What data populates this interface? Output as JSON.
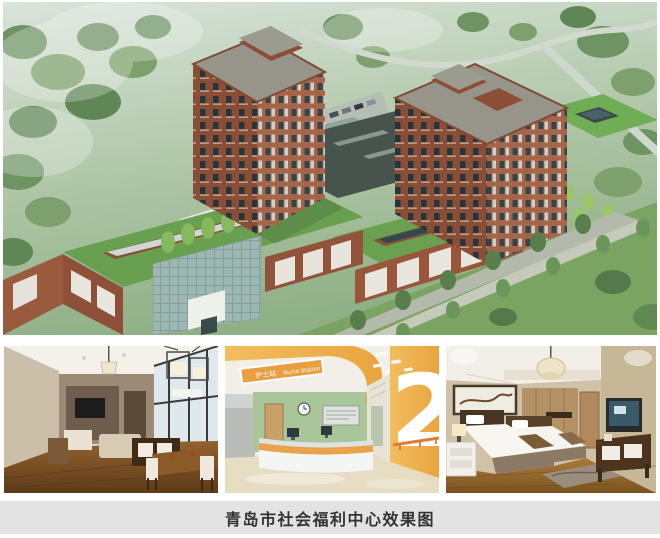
{
  "caption": {
    "text": "青岛市社会福利中心效果图"
  },
  "photos": {
    "nurse_station": {
      "sign_zh": "护士站",
      "sign_en": "Nurse Station",
      "floor_number": "2"
    }
  },
  "colors": {
    "page_bg": "#ffffff",
    "caption_bar_bg": "#e3e3e3",
    "caption_text": "#333333",
    "brick": "#8c4f37",
    "roof_green": "#69a04f",
    "accent_orange": "#eda94e",
    "wall_green": "#a9c69b"
  }
}
